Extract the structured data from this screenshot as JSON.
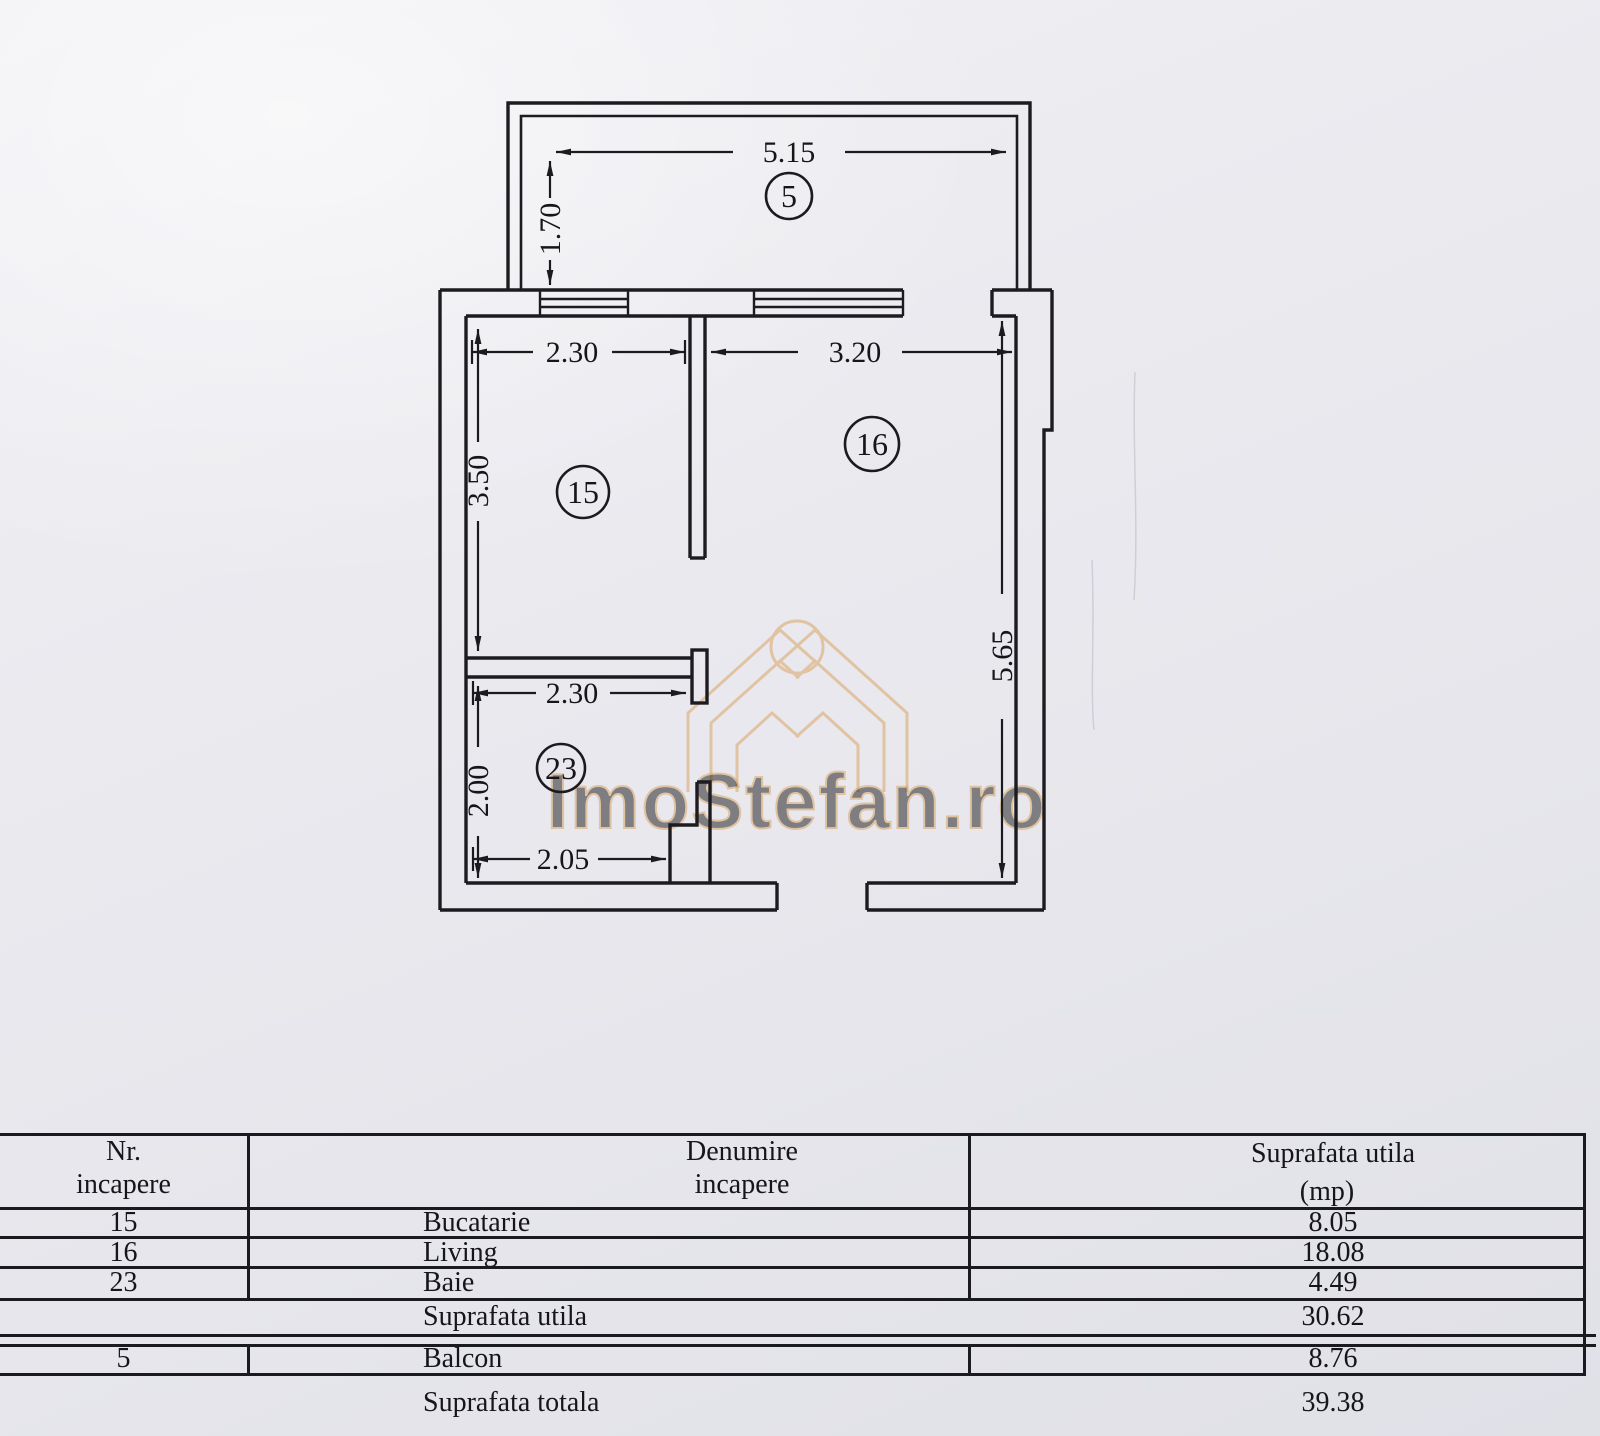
{
  "plan": {
    "labels": {
      "balcony": "5",
      "kitchen": "15",
      "living": "16",
      "bath": "23"
    },
    "dims": {
      "balcony_width": "5.15",
      "balcony_depth": "1.70",
      "kitchen_width": "2.30",
      "kitchen_depth": "3.50",
      "living_width": "3.20",
      "living_depth": "5.65",
      "bath_width": "2.30",
      "bath_depth": "2.00",
      "bath_bottom_width": "2.05"
    },
    "watermark": "ImoStefan.ro"
  },
  "table": {
    "headers": {
      "col1_line1": "Nr.",
      "col1_line2": "incapere",
      "col2_line1": "Denumire",
      "col2_line2": "incapere",
      "col3_line1": "Suprafata utila",
      "col3_line2": "(mp)"
    },
    "rows": [
      {
        "nr": "15",
        "name": "Bucatarie",
        "area": "8.05"
      },
      {
        "nr": "16",
        "name": "Living",
        "area": "18.08"
      },
      {
        "nr": "23",
        "name": "Baie",
        "area": "4.49"
      }
    ],
    "subtotal": {
      "label": "Suprafata utila",
      "value": "30.62"
    },
    "balcony_row": {
      "nr": "5",
      "name": "Balcon",
      "area": "8.76"
    },
    "total": {
      "label": "Suprafata totala",
      "value": "39.38"
    }
  }
}
